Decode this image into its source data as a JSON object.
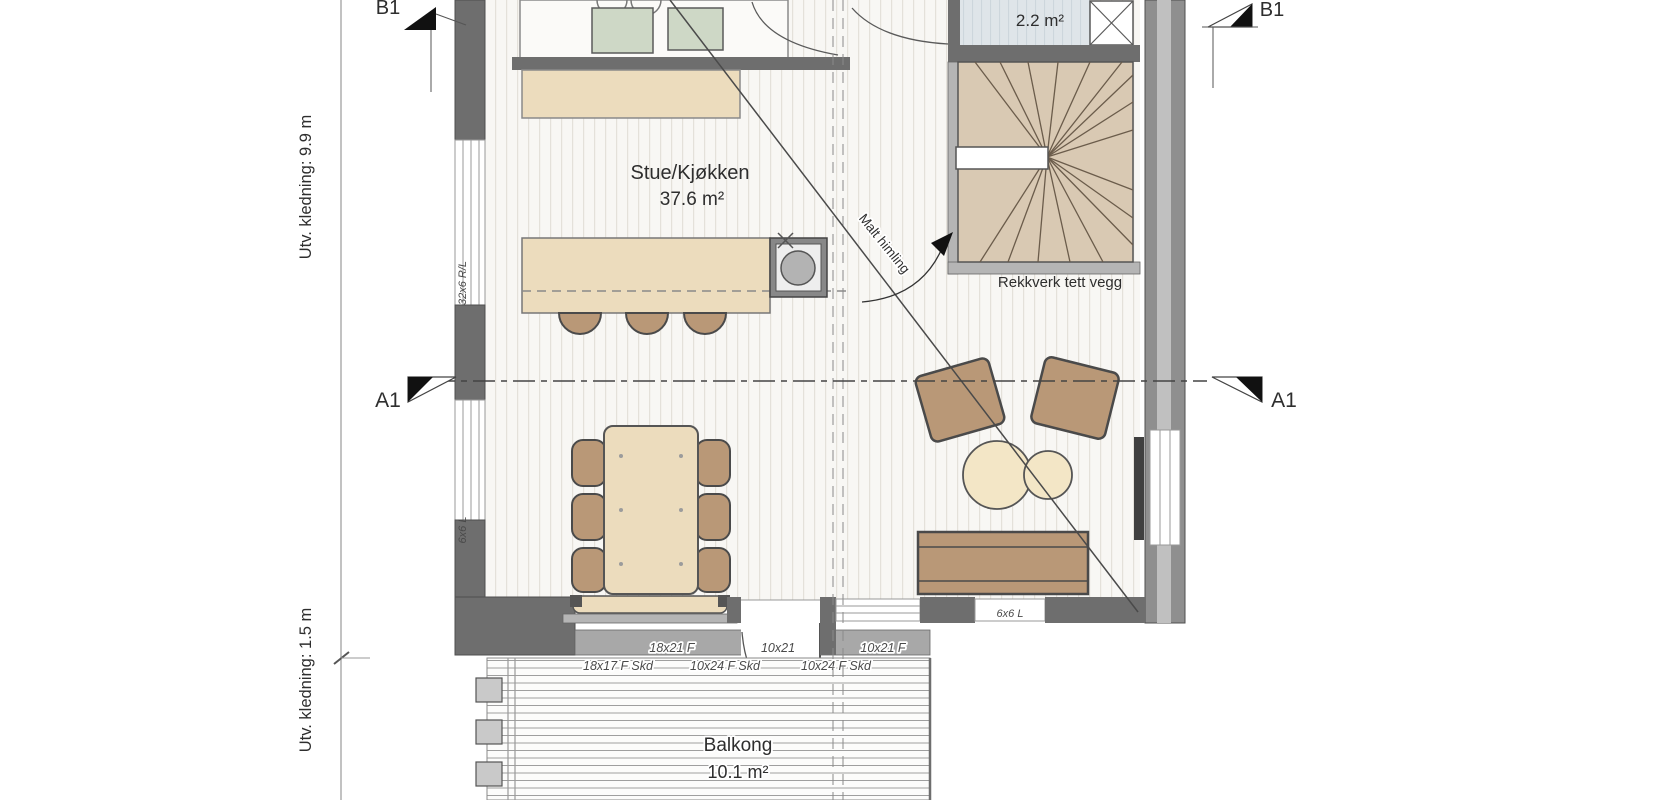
{
  "plan": {
    "rooms": {
      "living_kitchen": {
        "name": "Stue/Kjøkken",
        "area": "37.6 m²"
      },
      "wc": {
        "area": "2.2 m²"
      },
      "balcony": {
        "name": "Balkong",
        "area": "10.1 m²"
      }
    },
    "sections": {
      "a1": "A1",
      "b1": "B1"
    },
    "annotations": {
      "ceiling_note": "Malt himling",
      "stair_note": "Rekkverk tett vegg",
      "dim_left_top": "Utv. kledning: 9.9 m",
      "dim_left_bottom": "Utv. kledning: 1.5 m",
      "wall_note_top": "32x6 R/L",
      "wall_note_bottom": "6x6 L",
      "bottom_wall_note": "6x6 L"
    },
    "openings": {
      "row1": [
        "18x21 F",
        "10x21",
        "10x21 F"
      ],
      "row2": [
        "18x17 F Skd",
        "10x24 F Skd",
        "10x24 F Skd"
      ]
    },
    "colors": {
      "wall_dark": "#6e6e6e",
      "wall_light": "#a8a8a8",
      "wood_beige": "#ecdcbd",
      "furniture_brown": "#b99877",
      "stair_tan": "#d9c9b3",
      "wc_floor": "#dfe5e9",
      "appliance_green": "#ced8c6",
      "table_cream": "#f3e6c6",
      "line_dark": "#4a4a4a"
    }
  }
}
